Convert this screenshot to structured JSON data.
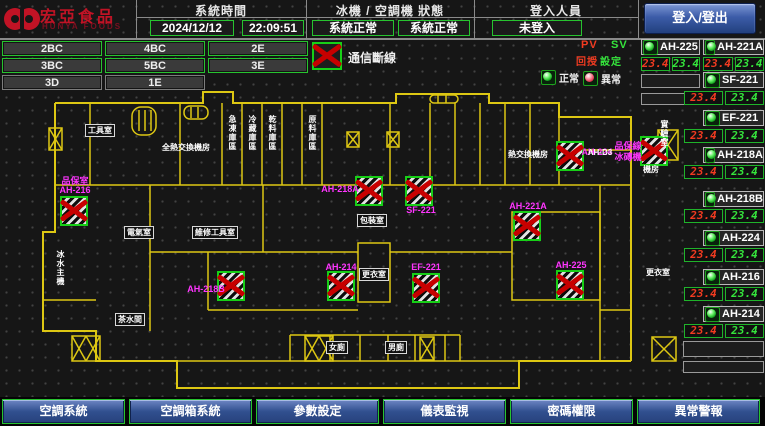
{
  "header": {
    "brand": "宏亞食品",
    "brand_en": "HUNYA FOODS",
    "system_time_label": "系統時間",
    "date": "2024/12/12",
    "time": "22:09:51",
    "machine_status_label": "冰機 / 空調機 狀態",
    "chiller_status": "系統正常",
    "ac_status": "系統正常",
    "login_label": "登入人員",
    "login_value": "未登入",
    "login_button": "登入/登出"
  },
  "floors": [
    "2BC",
    "4BC",
    "2E",
    "3BC",
    "5BC",
    "3E",
    "3D",
    "1E"
  ],
  "legend": {
    "comm_loss": "通信斷線",
    "pv": "PV",
    "sv": "SV",
    "pv_name": "回授",
    "sv_name": "設定",
    "normal": "正常",
    "abnormal": "異常"
  },
  "units": [
    {
      "name": "AH-225",
      "pv": "23.4",
      "sv": "23.4"
    },
    {
      "name": "AH-221A",
      "pv": "23.4",
      "sv": "23.4"
    },
    {
      "name": "SF-221",
      "pv": "23.4",
      "sv": "23.4"
    },
    {
      "name": "EF-221",
      "pv": "23.4",
      "sv": "23.4"
    },
    {
      "name": "AH-218A",
      "pv": "23.4",
      "sv": "23.4"
    },
    {
      "name": "AH-218B",
      "pv": "23.4",
      "sv": "23.4"
    },
    {
      "name": "AH-224",
      "pv": "23.4",
      "sv": "23.4"
    },
    {
      "name": "AH-216",
      "pv": "23.4",
      "sv": "23.4"
    },
    {
      "name": "AH-214",
      "pv": "23.4",
      "sv": "23.4"
    }
  ],
  "map": {
    "markers": [
      {
        "x": 60,
        "y": 196
      },
      {
        "x": 217,
        "y": 271
      },
      {
        "x": 327,
        "y": 271
      },
      {
        "x": 355,
        "y": 176
      },
      {
        "x": 405,
        "y": 176
      },
      {
        "x": 412,
        "y": 273
      },
      {
        "x": 513,
        "y": 211
      },
      {
        "x": 556,
        "y": 141
      },
      {
        "x": 640,
        "y": 136
      },
      {
        "x": 556,
        "y": 270
      }
    ],
    "unit_labels": [
      {
        "t": "品保室",
        "x": 75,
        "y": 174
      },
      {
        "t": "AH-216",
        "x": 75,
        "y": 185
      },
      {
        "t": "AH-218A",
        "x": 340,
        "y": 184
      },
      {
        "t": "SF-221",
        "x": 421,
        "y": 205
      },
      {
        "t": "AH-218B",
        "x": 206,
        "y": 284
      },
      {
        "t": "AH-214",
        "x": 341,
        "y": 262
      },
      {
        "t": "EF-221",
        "x": 426,
        "y": 262
      },
      {
        "t": "AH-221A",
        "x": 528,
        "y": 201
      },
      {
        "t": "AH-225",
        "x": 571,
        "y": 260
      },
      {
        "t": "AH-224",
        "x": 597,
        "y": 147
      },
      {
        "t": "品保線",
        "x": 628,
        "y": 139
      },
      {
        "t": "冰磚機",
        "x": 628,
        "y": 150
      }
    ],
    "rooms": [
      {
        "t": "工具室",
        "x": 100,
        "y": 124,
        "b": true
      },
      {
        "t": "全熱交換機房",
        "x": 186,
        "y": 143
      },
      {
        "t": "急凍庫區",
        "x": 228,
        "y": 115,
        "v": true
      },
      {
        "t": "冷藏庫區",
        "x": 248,
        "y": 115,
        "v": true
      },
      {
        "t": "乾料庫區",
        "x": 268,
        "y": 115,
        "v": true
      },
      {
        "t": "原料庫區",
        "x": 308,
        "y": 115,
        "v": true
      },
      {
        "t": "AH-D3",
        "x": 600,
        "y": 148
      },
      {
        "t": "熱交換機房",
        "x": 528,
        "y": 150
      },
      {
        "t": "實驗室",
        "x": 660,
        "y": 120,
        "v": true
      },
      {
        "t": "電氣室",
        "x": 139,
        "y": 226,
        "b": true
      },
      {
        "t": "維修工具室",
        "x": 215,
        "y": 226,
        "b": true
      },
      {
        "t": "包裝室",
        "x": 372,
        "y": 214,
        "b": true
      },
      {
        "t": "更衣室",
        "x": 374,
        "y": 268,
        "b": true
      },
      {
        "t": "冰水主機",
        "x": 56,
        "y": 250,
        "v": true
      },
      {
        "t": "茶水間",
        "x": 130,
        "y": 313,
        "b": true
      },
      {
        "t": "女廁",
        "x": 337,
        "y": 341,
        "b": true
      },
      {
        "t": "男廁",
        "x": 396,
        "y": 341,
        "b": true
      },
      {
        "t": "機房",
        "x": 651,
        "y": 165
      },
      {
        "t": "更衣室",
        "x": 658,
        "y": 268
      }
    ]
  },
  "nav": [
    "空調系統",
    "空調箱系統",
    "參數設定",
    "儀表監視",
    "密碼權限",
    "異常警報"
  ]
}
